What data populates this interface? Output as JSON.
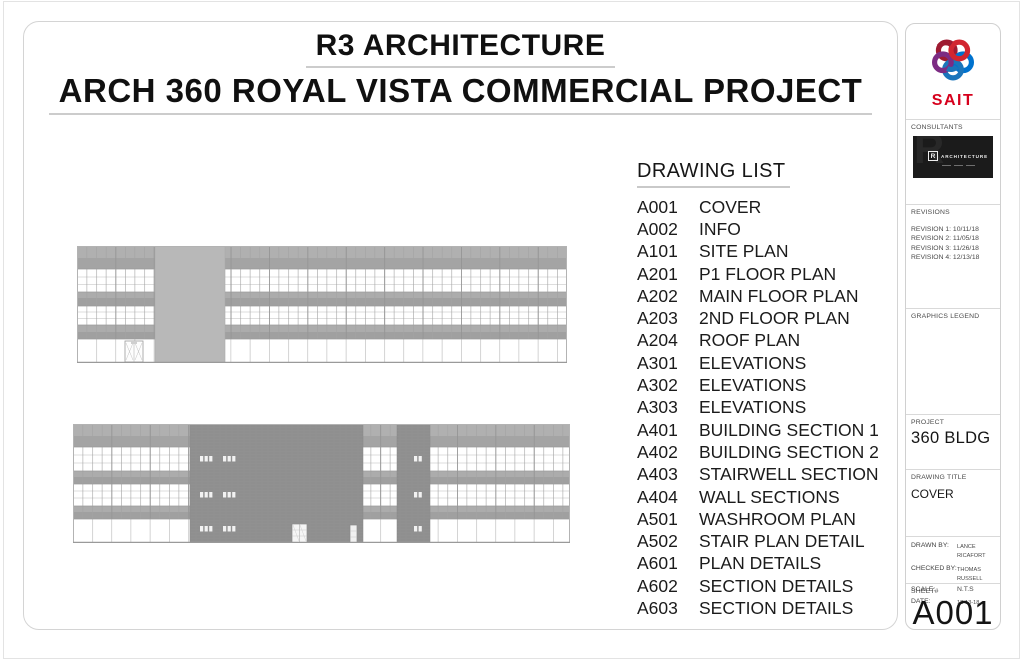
{
  "titles": {
    "line1": "R3 ARCHITECTURE",
    "line2": "ARCH 360 ROYAL VISTA COMMERCIAL PROJECT"
  },
  "drawing_list": {
    "header": "DRAWING LIST",
    "items": [
      {
        "no": "A001",
        "name": "COVER"
      },
      {
        "no": "A002",
        "name": "INFO"
      },
      {
        "no": "A101",
        "name": "SITE PLAN"
      },
      {
        "no": "A201",
        "name": "P1 FLOOR PLAN"
      },
      {
        "no": "A202",
        "name": "MAIN FLOOR PLAN"
      },
      {
        "no": "A203",
        "name": "2ND FLOOR PLAN"
      },
      {
        "no": "A204",
        "name": "ROOF PLAN"
      },
      {
        "no": "A301",
        "name": "ELEVATIONS"
      },
      {
        "no": "A302",
        "name": "ELEVATIONS"
      },
      {
        "no": "A303",
        "name": "ELEVATIONS"
      },
      {
        "no": "A401",
        "name": "BUILDING SECTION 1"
      },
      {
        "no": "A402",
        "name": "BUILDING SECTION 2"
      },
      {
        "no": "A403",
        "name": "STAIRWELL SECTION"
      },
      {
        "no": "A404",
        "name": "WALL SECTIONS"
      },
      {
        "no": "A501",
        "name": "WASHROOM PLAN"
      },
      {
        "no": "A502",
        "name": "STAIR PLAN DETAIL"
      },
      {
        "no": "A601",
        "name": "PLAN DETAILS"
      },
      {
        "no": "A602",
        "name": "SECTION DETAILS"
      },
      {
        "no": "A603",
        "name": "SECTION DETAILS"
      }
    ]
  },
  "sidebar": {
    "logo_wordmark": "SAIT",
    "consultants": {
      "label": "CONSULTANTS",
      "card_mark": "R",
      "card_watermark": "R",
      "card_brand": "ARCHITECTURE"
    },
    "revisions": {
      "label": "REVISIONS",
      "entries": [
        "REVISION 1: 10/11/18",
        "REVISION 2: 11/05/18",
        "REVISION 3: 11/26/18",
        "REVISION 4: 12/13/18"
      ]
    },
    "graphics_legend": {
      "label": "GRAPHICS LEGEND"
    },
    "project": {
      "label": "PROJECT",
      "value": "360 BLDG"
    },
    "drawing_title": {
      "label": "DRAWING TITLE",
      "value": "COVER"
    },
    "info": {
      "drawn_by_label": "DRAWN BY:",
      "drawn_by": "LANCE RICAFORT",
      "checked_by_label": "CHECKED BY:",
      "checked_by": "THOMAS RUSSELL",
      "scale_label": "SCALE:",
      "scale": "N.T.S",
      "date_label": "DATE:",
      "date": "12-13-18"
    },
    "sheet": {
      "label": "SHEET#",
      "number": "A001"
    }
  },
  "colors": {
    "sait_red": "#d6001c",
    "logo_loop_colors": [
      "#9e1b32",
      "#d22630",
      "#0072ce",
      "#1b75bb",
      "#7c2b83"
    ],
    "spandrel_gray": "#acacac",
    "core_block_gray_light": "#b8b8b8",
    "masonry_block_gray_dark": "#8f8f8f",
    "frame_gray": "#d4d4d4"
  }
}
